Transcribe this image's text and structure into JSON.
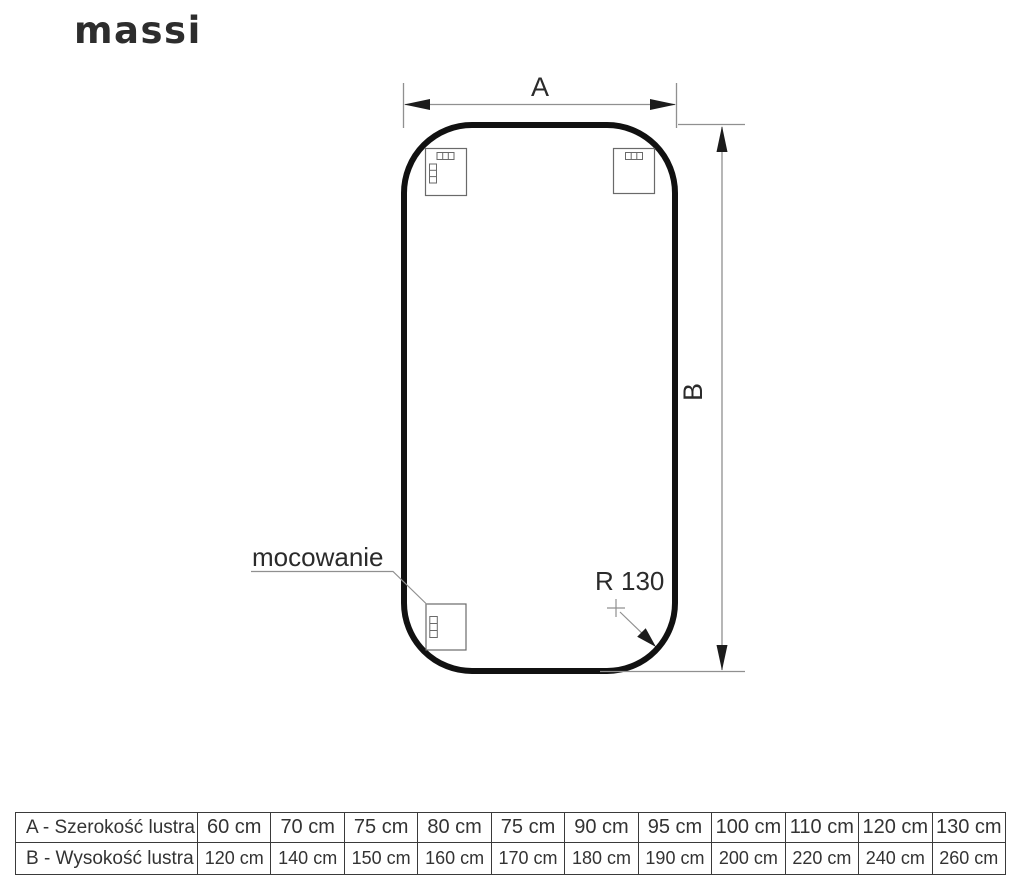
{
  "brand": {
    "logo_text": "massi"
  },
  "diagram": {
    "labels": {
      "width_dim": "A",
      "height_dim": "B",
      "mounting": "mocowanie",
      "radius": "R 130"
    },
    "colors": {
      "mirror_outline": "#111111",
      "dimension_line": "#909090",
      "arrowhead": "#1c1c1c",
      "text": "#2b2b2b"
    }
  },
  "table": {
    "rows": [
      {
        "label": "A - Szerokość lustra",
        "values": [
          "60 cm",
          "70 cm",
          "75 cm",
          "80 cm",
          "75 cm",
          "90 cm",
          "95 cm",
          "100 cm",
          "110 cm",
          "120 cm",
          "130 cm"
        ]
      },
      {
        "label": "B - Wysokość lustra",
        "values": [
          "120 cm",
          "140 cm",
          "150 cm",
          "160 cm",
          "170 cm",
          "180 cm",
          "190 cm",
          "200 cm",
          "220 cm",
          "240 cm",
          "260 cm"
        ]
      }
    ]
  }
}
